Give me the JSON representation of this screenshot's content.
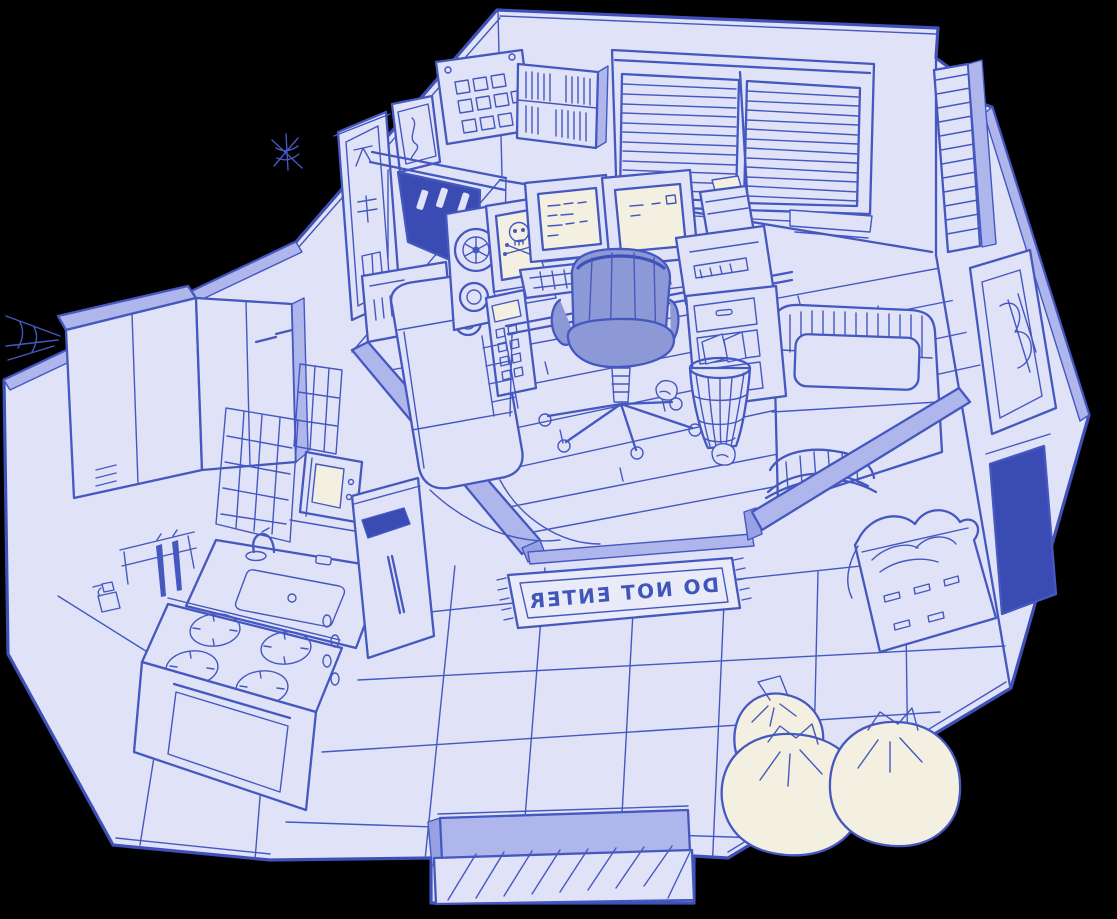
{
  "scene": {
    "title": "Isometric cutaway sketch of a studio apartment with computer corner",
    "style": "hand-drawn blue ink on lavender paper over a black backdrop",
    "palette": {
      "backdrop": "#000000",
      "paper": "#e0e3f7",
      "ink": "#4558bf",
      "wall_edge": "#aeb6ec",
      "alcove_dark": "#3a4cb3",
      "screen_cream": "#f3f0e2",
      "chair_upholstery": "#8d99d6",
      "mat_white": "#e9ebf9"
    }
  },
  "labels": {
    "doormat_text": "DO NOT ENTER",
    "doormat_note": "text is drawn mirrored on the mat"
  },
  "objects": [
    {
      "id": "window-blinds-large",
      "label": "Large double window with venetian blinds"
    },
    {
      "id": "window-blinds-small",
      "label": "Narrow side window with blinds"
    },
    {
      "id": "photo-pinboard",
      "label": "Pinboard with grid of photos"
    },
    {
      "id": "pinup-poster",
      "label": "Small wall poster"
    },
    {
      "id": "kanji-scroll",
      "label": "Hanging scroll with glyphs"
    },
    {
      "id": "wall-bookshelf",
      "label": "Wall-mounted bookshelf with books"
    },
    {
      "id": "fireplace-alcove",
      "label": "Dark alcove with candles"
    },
    {
      "id": "cobwebs",
      "label": "Cobwebs in wall corners"
    },
    {
      "id": "reel-to-reel-deck",
      "label": "Reel-to-reel tape deck"
    },
    {
      "id": "skull-monitor",
      "label": "CRT showing skull and crossbones"
    },
    {
      "id": "control-keypad",
      "label": "Keypad control panel"
    },
    {
      "id": "mainframe-machine",
      "label": "Large machine with porthole"
    },
    {
      "id": "amplifier-unit",
      "label": "Receiver with round dial"
    },
    {
      "id": "ladder-rack",
      "label": "Small ladder rack"
    },
    {
      "id": "crt-monitor-left",
      "label": "CRT terminal with text"
    },
    {
      "id": "crt-monitor-right",
      "label": "CRT terminal with text"
    },
    {
      "id": "dot-matrix-printer",
      "label": "Printer with sheet feeder"
    },
    {
      "id": "computer-desk",
      "label": "Computer desk"
    },
    {
      "id": "desk-drawers",
      "label": "Desk drawer pedestal"
    },
    {
      "id": "office-chair",
      "label": "Swivel office chair"
    },
    {
      "id": "wire-wastebasket",
      "label": "Wire wastebasket with papers"
    },
    {
      "id": "paper-balls",
      "label": "Crumpled paper balls"
    },
    {
      "id": "bed",
      "label": "Bed with hatched headboard and footboard"
    },
    {
      "id": "pillow",
      "label": "Pillow"
    },
    {
      "id": "interior-wall-left",
      "label": "Interior partition wall (left)"
    },
    {
      "id": "interior-wall-right",
      "label": "Interior partition wall (right)"
    },
    {
      "id": "floor-step-edge",
      "label": "Raised plank floor edge"
    },
    {
      "id": "picture-frame",
      "label": "Picture frame on outer wall"
    },
    {
      "id": "dark-doorway",
      "label": "Dark doorway on outer wall"
    },
    {
      "id": "laundry-basket",
      "label": "Laundry basket with clothes"
    },
    {
      "id": "upper-cabinets",
      "label": "Kitchen upper cabinets"
    },
    {
      "id": "knife-rack",
      "label": "Rack with hanging knives"
    },
    {
      "id": "spray-bottle",
      "label": "Spray bottle on floor"
    },
    {
      "id": "backsplash-tiles",
      "label": "Tiled backsplash"
    },
    {
      "id": "microwave",
      "label": "Microwave oven"
    },
    {
      "id": "kitchen-sink",
      "label": "Sink with faucet"
    },
    {
      "id": "stove-burners",
      "label": "Stove top with four burners"
    },
    {
      "id": "oven",
      "label": "Oven with door"
    },
    {
      "id": "tall-cabinet-towel",
      "label": "End cabinet with towel and handle"
    },
    {
      "id": "doormat",
      "label": "Doormat with mirrored warning text"
    },
    {
      "id": "trash-bags",
      "label": "Three tied trash bags"
    },
    {
      "id": "entrance-step",
      "label": "Entrance step with hatching"
    },
    {
      "id": "floor-planks",
      "label": "Wooden plank floor (computer corner)"
    },
    {
      "id": "floor-tiles",
      "label": "Large floor tiles (main room)"
    }
  ]
}
